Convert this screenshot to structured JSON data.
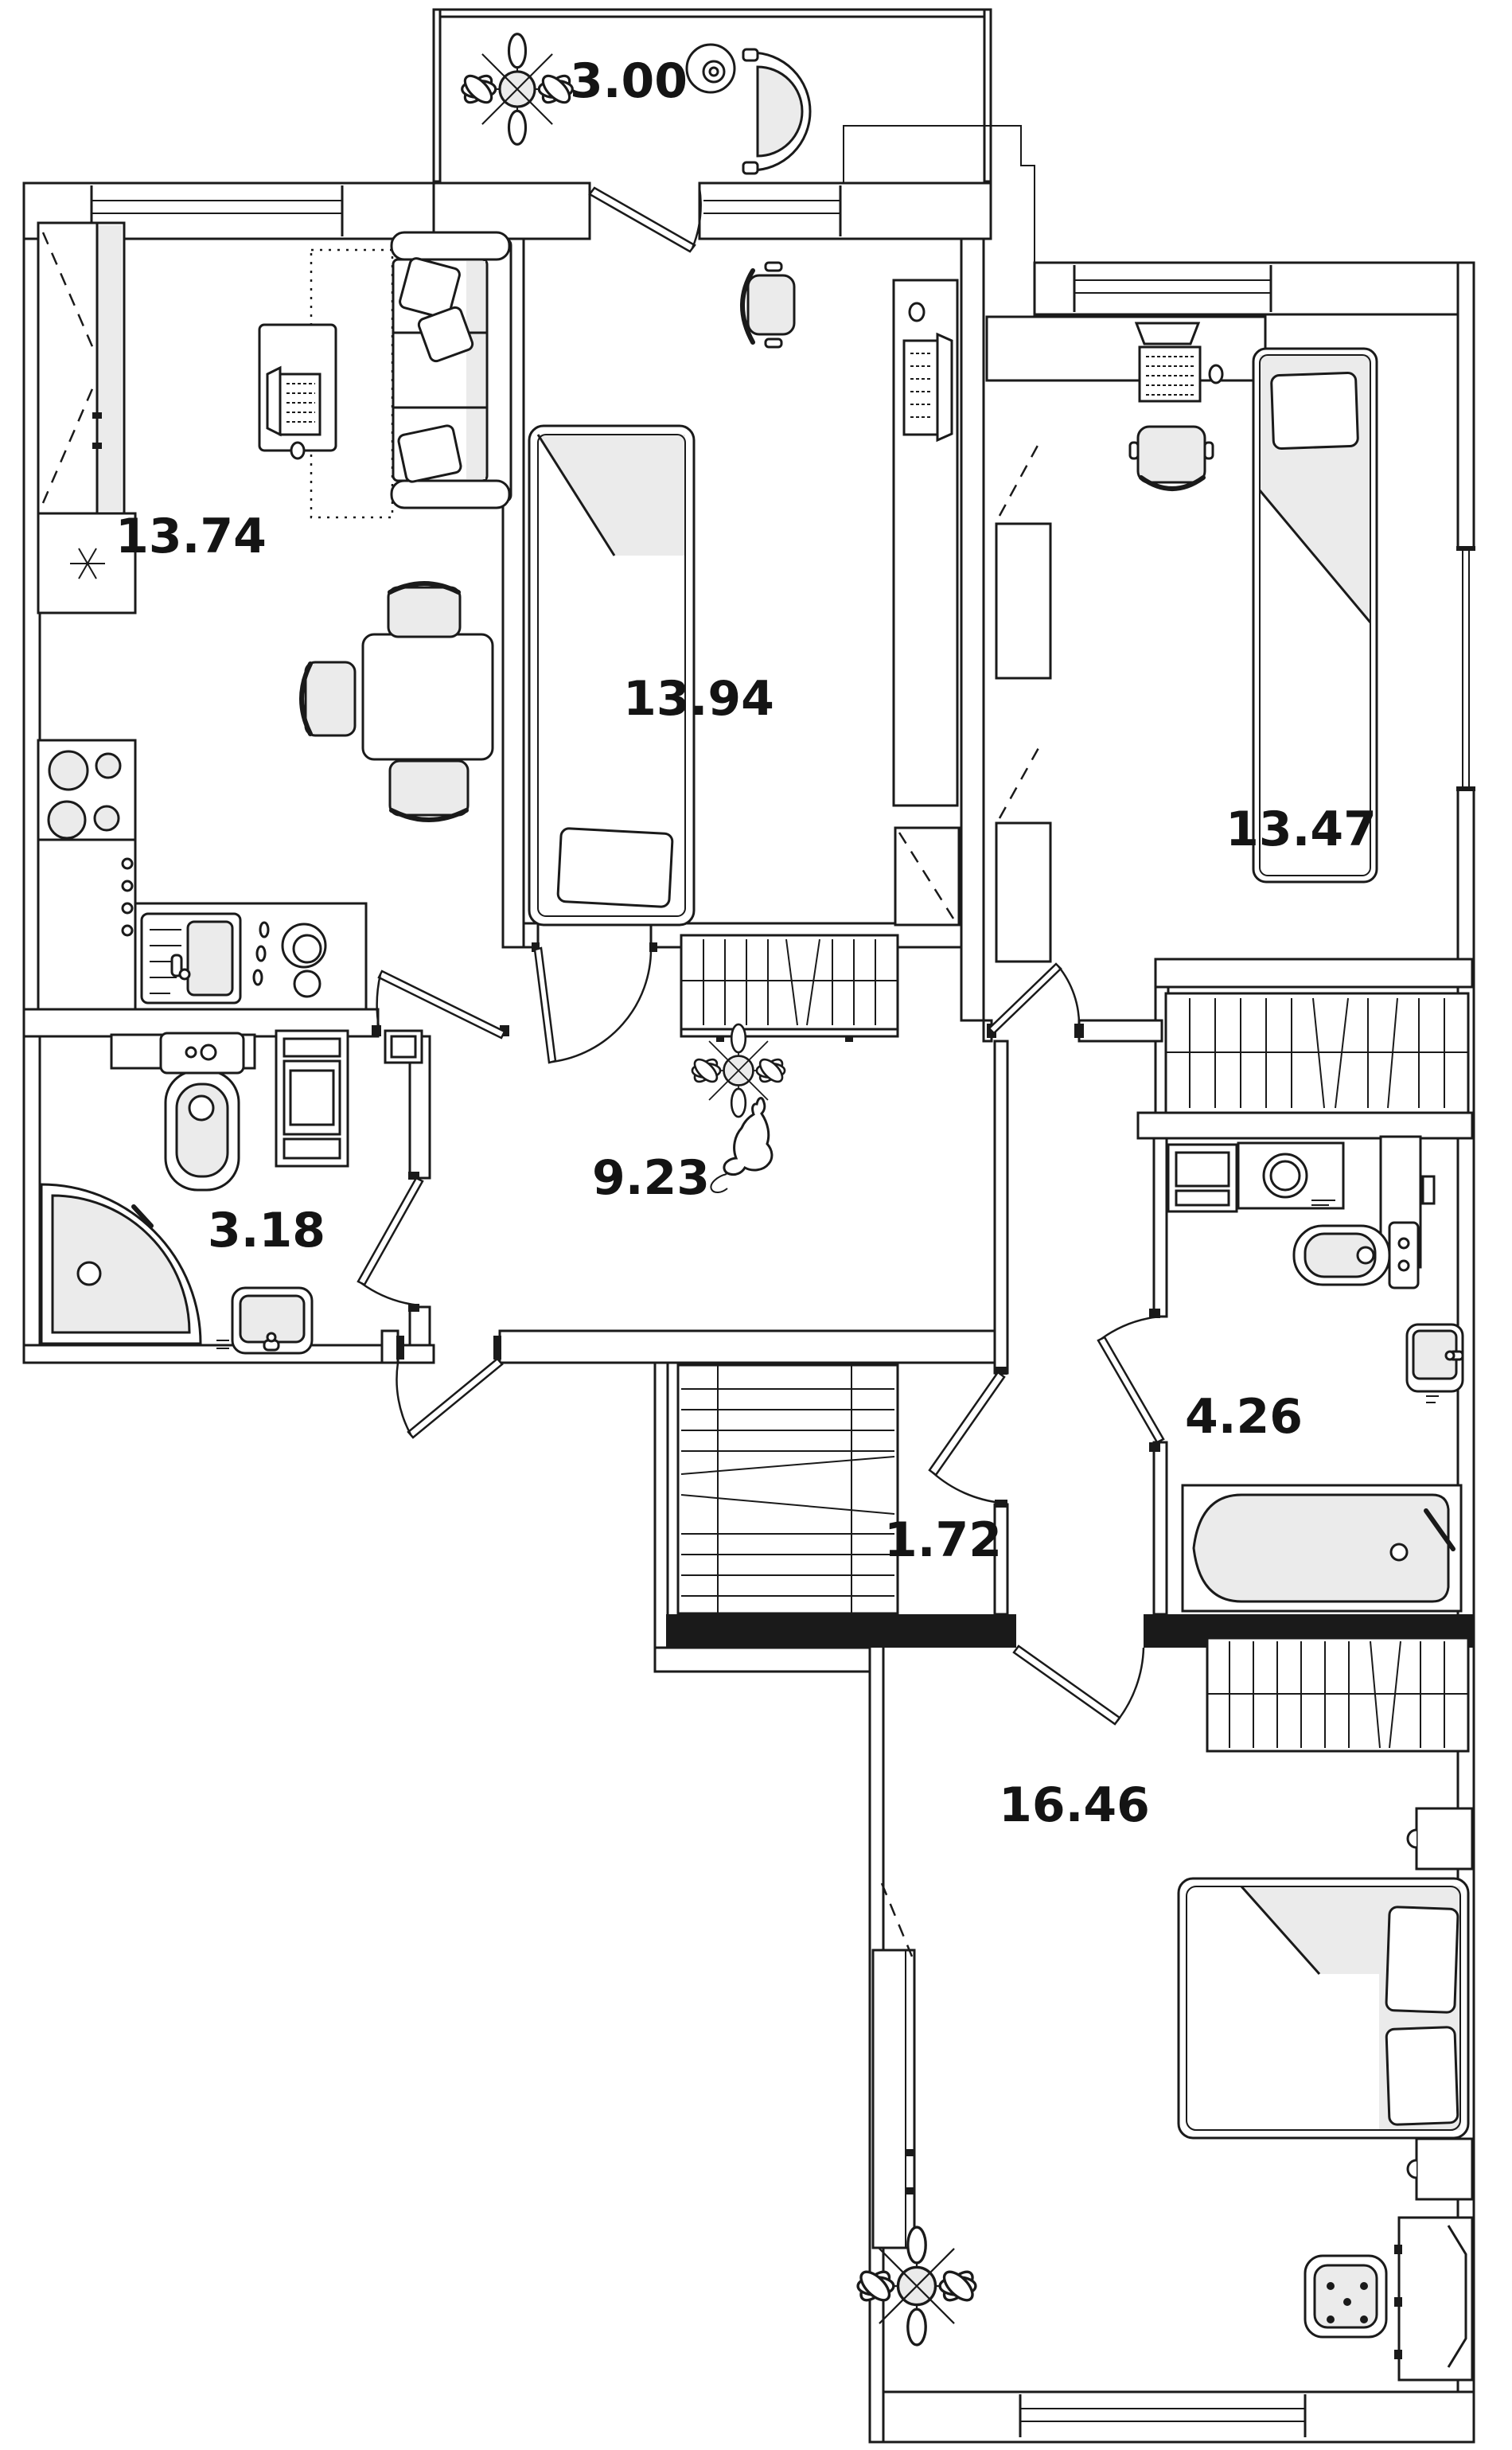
{
  "colors": {
    "line": "#1a1a1a",
    "background": "#ffffff",
    "furniture_fill": "#ebebeb"
  },
  "rooms": {
    "balcony": {
      "area": "3.00"
    },
    "kitchen_living": {
      "area": "13.74"
    },
    "bedroom_2": {
      "area": "13.94"
    },
    "bedroom_3": {
      "area": "13.47"
    },
    "shower_room": {
      "area": "3.18"
    },
    "hallway": {
      "area": "9.23"
    },
    "bathroom": {
      "area": "4.26"
    },
    "closet": {
      "area": "1.72"
    },
    "master_bedroom": {
      "area": "16.46"
    }
  }
}
